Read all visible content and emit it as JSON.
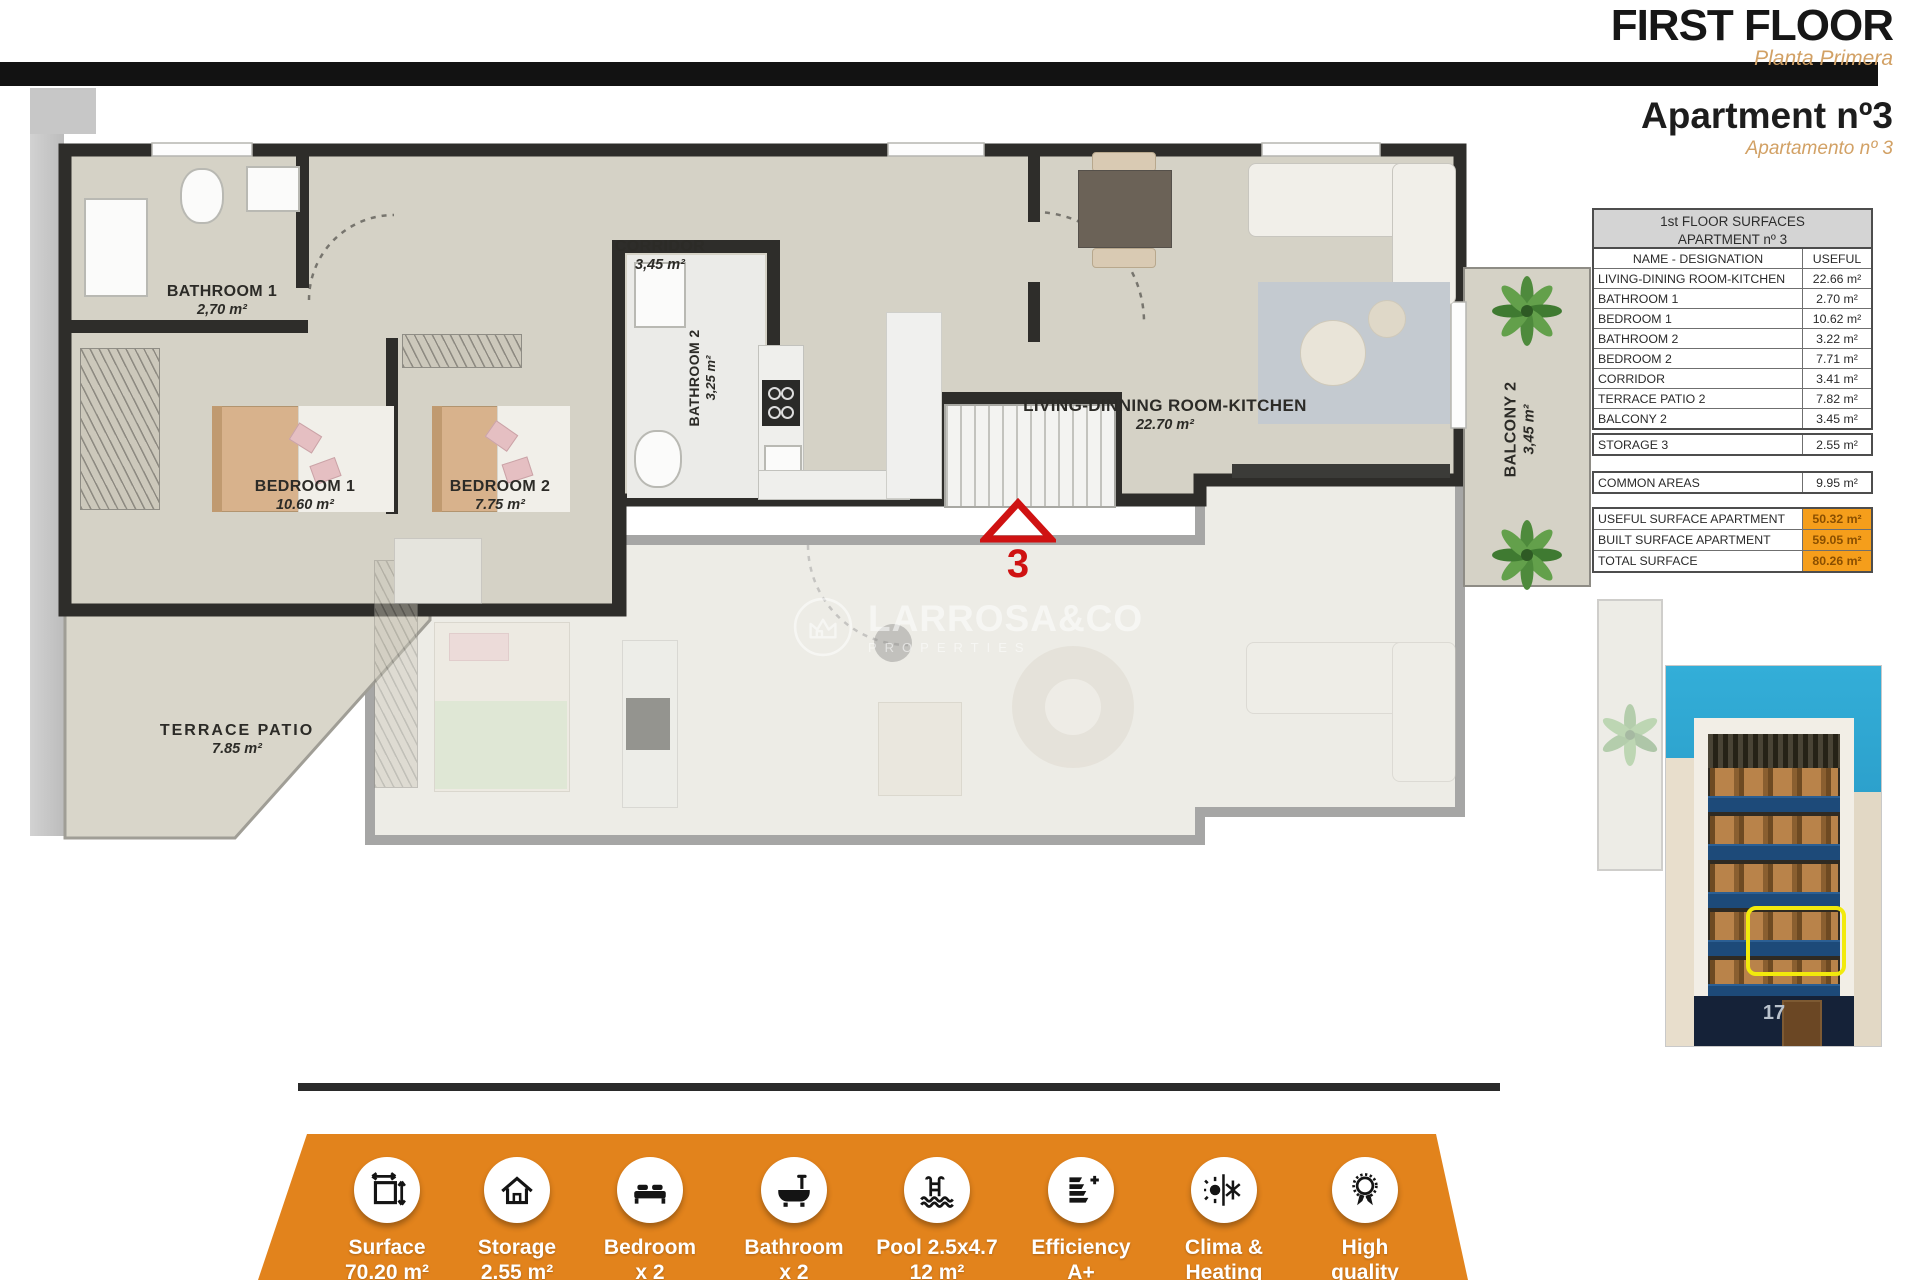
{
  "header": {
    "title": "FIRST FLOOR",
    "subtitle": "Planta Primera",
    "apartment_title": "Apartment nº3",
    "apartment_subtitle": "Apartamento nº 3"
  },
  "plan": {
    "rooms": {
      "bathroom1": {
        "name": "BATHROOM 1",
        "area": "2,70 m²"
      },
      "corridor": {
        "name": "CORRIDOR",
        "area": "3,45 m²"
      },
      "bathroom2": {
        "name": "BATHROOM 2",
        "area": "3,25 m²"
      },
      "bedroom1": {
        "name": "BEDROOM 1",
        "area": "10.60 m²"
      },
      "bedroom2": {
        "name": "BEDROOM 2",
        "area": "7.75 m²"
      },
      "living": {
        "name": "LIVING-DINNING ROOM-KITCHEN",
        "area": "22.70 m²"
      },
      "terrace": {
        "name": "TERRACE PATIO",
        "area": "7.85 m²"
      },
      "balcony": {
        "name": "BALCONY 2",
        "area": "3,45 m²"
      }
    },
    "marker": "3",
    "watermark": {
      "brand": "LARROSA&CO",
      "tagline": "PROPERTIES"
    }
  },
  "surfaces_table": {
    "title_line1": "1st FLOOR SURFACES",
    "title_line2": "APARTMENT nº 3",
    "col_name": "NAME - DESIGNATION",
    "col_useful": "USEFUL",
    "rows": [
      {
        "name": "LIVING-DINING ROOM-KITCHEN",
        "value": "22.66 m²"
      },
      {
        "name": "BATHROOM 1",
        "value": "2.70 m²"
      },
      {
        "name": "BEDROOM 1",
        "value": "10.62 m²"
      },
      {
        "name": "BATHROOM 2",
        "value": "3.22 m²"
      },
      {
        "name": "BEDROOM 2",
        "value": "7.71 m²"
      },
      {
        "name": "CORRIDOR",
        "value": "3.41 m²"
      },
      {
        "name": "TERRACE PATIO 2",
        "value": "7.82 m²"
      },
      {
        "name": "BALCONY 2",
        "value": "3.45 m²"
      }
    ],
    "storage": {
      "name": "STORAGE 3",
      "value": "2.55 m²"
    },
    "common": {
      "name": "COMMON AREAS",
      "value": "9.95 m²"
    },
    "totals": [
      {
        "name": "USEFUL SURFACE APARTMENT",
        "value": "50.32 m²"
      },
      {
        "name": "BUILT SURFACE APARTMENT",
        "value": "59.05 m²"
      },
      {
        "name": "TOTAL SURFACE",
        "value": "80.26 m²"
      }
    ]
  },
  "building_photo": {
    "street_number": "17"
  },
  "bottom_bar": {
    "items": [
      {
        "line1": "Surface",
        "line2": "70.20 m²"
      },
      {
        "line1": "Storage",
        "line2": "2.55 m²"
      },
      {
        "line1": "Bedroom",
        "line2": "x 2"
      },
      {
        "line1": "Bathroom",
        "line2": "x 2"
      },
      {
        "line1": "Pool 2.5x4.7",
        "line2": "12 m²"
      },
      {
        "line1": "Efficiency",
        "line2": "A+"
      },
      {
        "line1": "Clima &",
        "line2": "Heating"
      },
      {
        "line1": "High",
        "line2": "quality"
      }
    ]
  },
  "colors": {
    "accent_orange": "#E2831C",
    "highlight_orange": "#F59E1B",
    "subtitle_tan": "#D2A165",
    "marker_red": "#CF1212",
    "plan_floor": "#D5D2C6",
    "wall_dark": "#2E2D2A"
  }
}
